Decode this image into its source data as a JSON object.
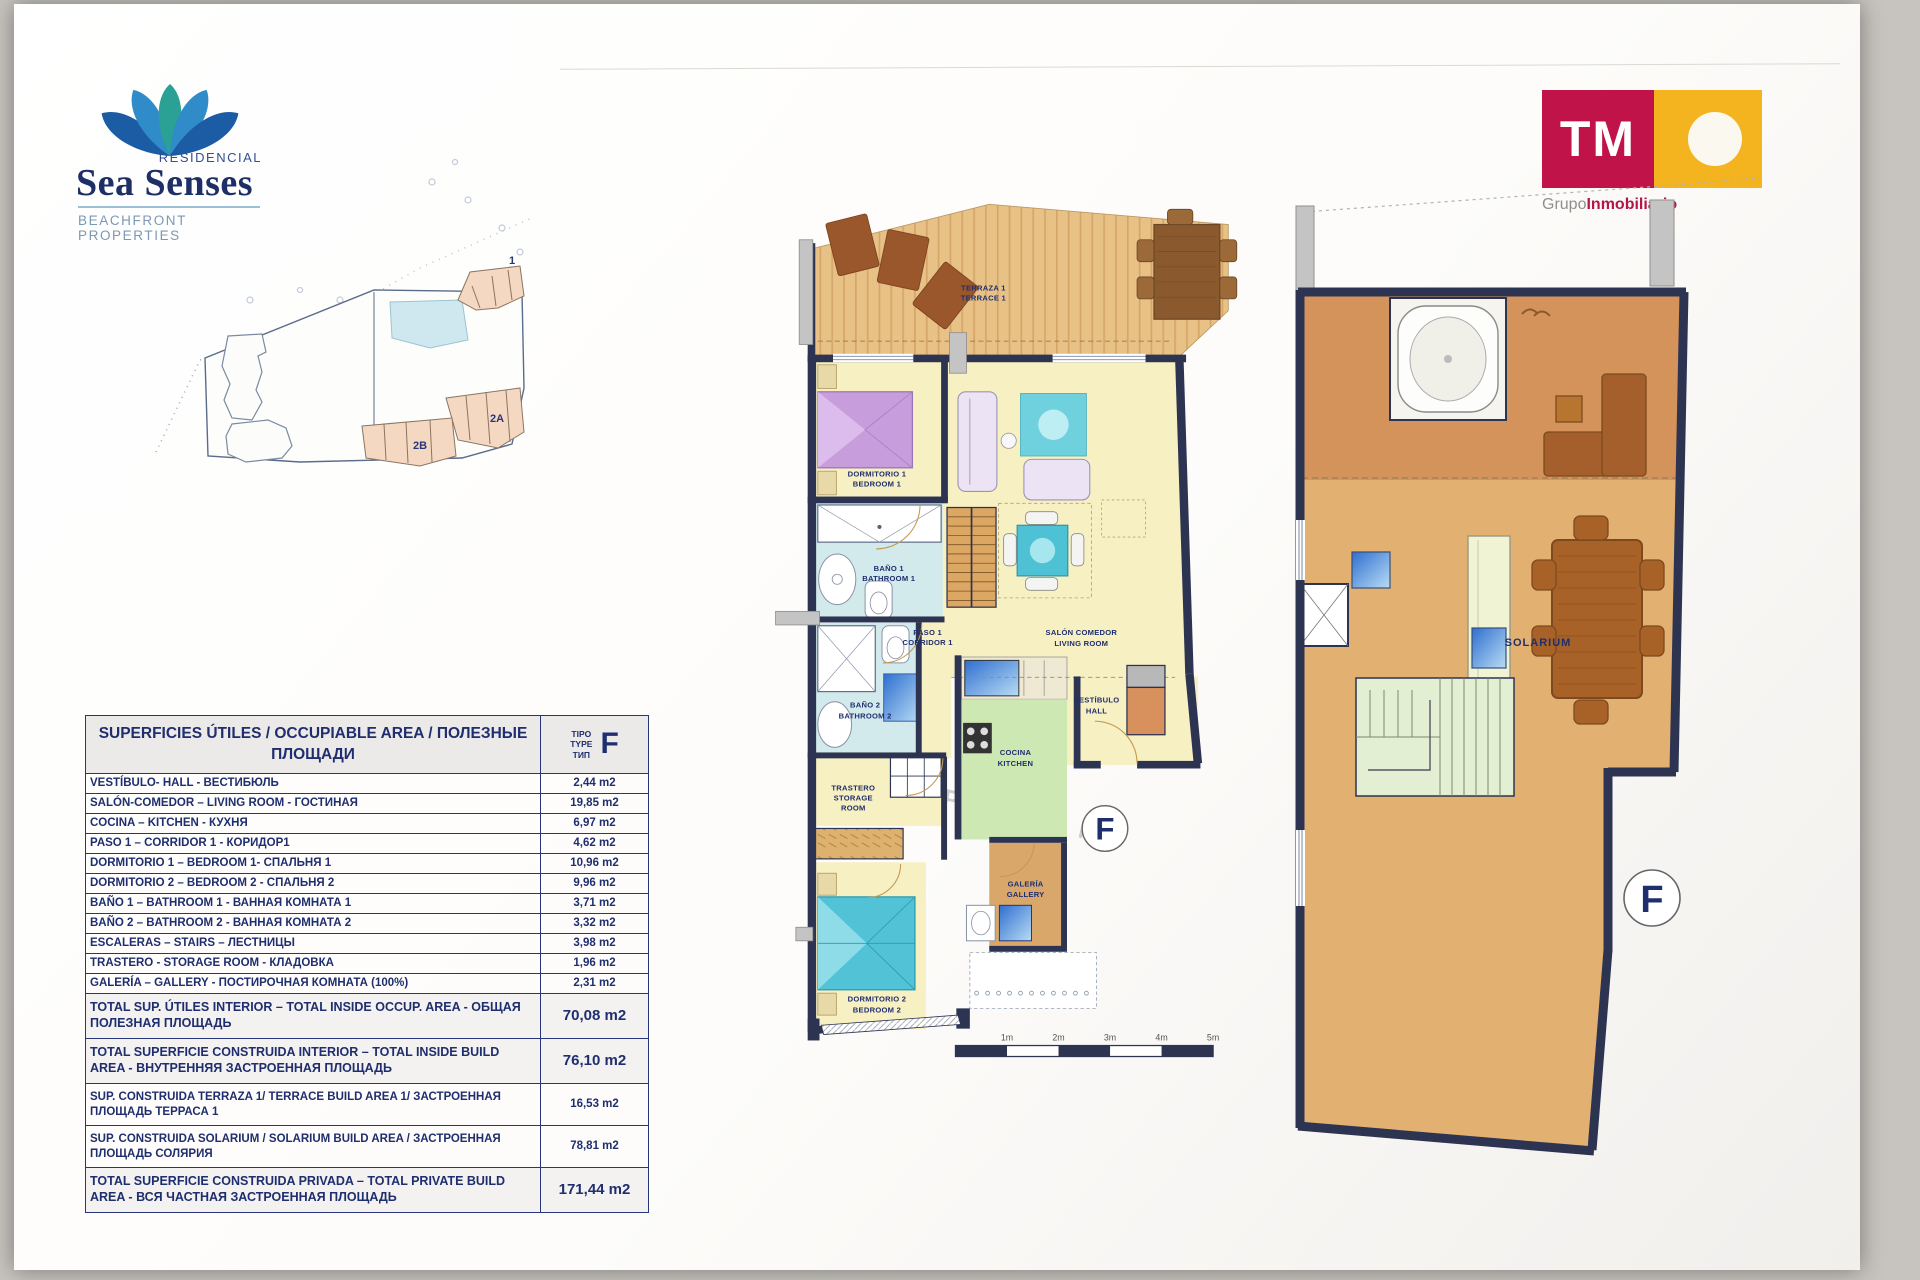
{
  "branding": {
    "residencial": "RESIDENCIAL",
    "name": "Sea Senses",
    "tagline": "BEACHFRONT PROPERTIES",
    "tm_logo": "TM",
    "tm_group_gray": "Grupo",
    "tm_group_red": "Inmobiliario"
  },
  "site_plan": {
    "block_1": "1",
    "block_2a": "2A",
    "block_2b": "2B"
  },
  "area_table": {
    "title": "SUPERFICIES ÚTILES / OCCUPIABLE AREA / ПОЛЕЗНЫЕ ПЛОЩАДИ",
    "type_label_1": "TIPO",
    "type_label_2": "TYPE",
    "type_label_3": "ТИП",
    "type_letter": "F",
    "rows": [
      {
        "label": "VESTÍBULO- HALL - ВЕСТИБЮЛЬ",
        "value": "2,44 m2"
      },
      {
        "label": "SALÓN-COMEDOR – LIVING ROOM - ГОСТИНАЯ",
        "value": "19,85 m2"
      },
      {
        "label": "COCINA – KITCHEN - КУХНЯ",
        "value": "6,97 m2"
      },
      {
        "label": "PASO 1 – CORRIDOR 1 - КОРИДОР1",
        "value": "4,62 m2"
      },
      {
        "label": "DORMITORIO 1 – BEDROOM 1- СПАЛЬНЯ 1",
        "value": "10,96 m2"
      },
      {
        "label": "DORMITORIO 2 – BEDROOM 2 - СПАЛЬНЯ 2",
        "value": "9,96 m2"
      },
      {
        "label": "BAÑO 1 – BATHROOM 1 - ВАННАЯ КОМНАТА 1",
        "value": "3,71 m2"
      },
      {
        "label": "BAÑO 2 – BATHROOM 2 - ВАННАЯ КОМНАТА 2",
        "value": "3,32 m2"
      },
      {
        "label": "ESCALERAS – STAIRS – ЛЕСТНИЦЫ",
        "value": "3,98 m2"
      },
      {
        "label": "TRASTERO - STORAGE ROOM - КЛАДОВКА",
        "value": "1,96 m2"
      },
      {
        "label": "GALERÍA – GALLERY - ПОСТИРОЧНАЯ КОМНАТА (100%)",
        "value": "2,31 m2"
      },
      {
        "label": "TOTAL SUP. ÚTILES INTERIOR –  TOTAL INSIDE OCCUP. AREA - ОБЩАЯ ПОЛЕЗНАЯ ПЛОЩАДЬ",
        "value": "70,08 m2"
      },
      {
        "label": "TOTAL SUPERFICIE CONSTRUIDA INTERIOR –  TOTAL INSIDE BUILD AREA - ВНУТРЕННЯЯ ЗАСТРОЕННАЯ ПЛОЩАДЬ",
        "value": "76,10 m2"
      },
      {
        "label": "SUP. CONSTRUIDA TERRAZA 1/ TERRACE BUILD AREA 1/ ЗАСТРОЕННАЯ ПЛОЩАДЬ ТЕРРАСА 1",
        "value": "16,53 m2"
      },
      {
        "label": "SUP. CONSTRUIDA SOLARIUM / SOLARIUM BUILD AREA / ЗАСТРОЕННАЯ ПЛОЩАДЬ СОЛЯРИЯ",
        "value": "78,81 m2"
      },
      {
        "label": "TOTAL SUPERFICIE CONSTRUIDA PRIVADA – TOTAL PRIVATE BUILD AREA - ВСЯ ЧАСТНАЯ ЗАСТРОЕННАЯ ПЛОЩАДЬ",
        "value": "171,44 m2"
      }
    ]
  },
  "plan_left": {
    "terraza_1": "TERRAZA 1",
    "terraza_2": "TERRACE 1",
    "dorm1_1": "DORMITORIO 1",
    "dorm1_2": "BEDROOM 1",
    "bano1_1": "BAÑO 1",
    "bano1_2": "BATHROOM 1",
    "bano2_1": "BAÑO 2",
    "bano2_2": "BATHROOM 2",
    "paso_1": "PASO 1",
    "paso_2": "CORRIDOR 1",
    "salon_1": "SALÓN COMEDOR",
    "salon_2": "LIVING ROOM",
    "vest_1": "VESTÍBULO",
    "vest_2": "HALL",
    "cocina_1": "COCINA",
    "cocina_2": "KITCHEN",
    "trastero_1": "TRASTERO",
    "trastero_2": "STORAGE",
    "trastero_3": "ROOM",
    "galeria_1": "GALERÍA",
    "galeria_2": "GALLERY",
    "dorm2_1": "DORMITORIO 2",
    "dorm2_2": "BEDROOM 2",
    "type_letter": "F"
  },
  "plan_right": {
    "solarium": "SOLARIUM",
    "type_letter": "F",
    "watermark": "PASEO M"
  },
  "scale_bar": {
    "labels": [
      "1m",
      "2m",
      "3m",
      "4m",
      "5m"
    ]
  },
  "colors": {
    "navy": "#27357b",
    "wall": "#2d3452",
    "tm_red": "#c01349",
    "tm_yellow": "#f3b41f",
    "floor_yellow": "#f7f0c2",
    "terrace_wood": "#e8c186",
    "bath_blue": "#d3eaec",
    "kitchen_green": "#cde8b2",
    "solarium_tan": "#e2b172"
  }
}
